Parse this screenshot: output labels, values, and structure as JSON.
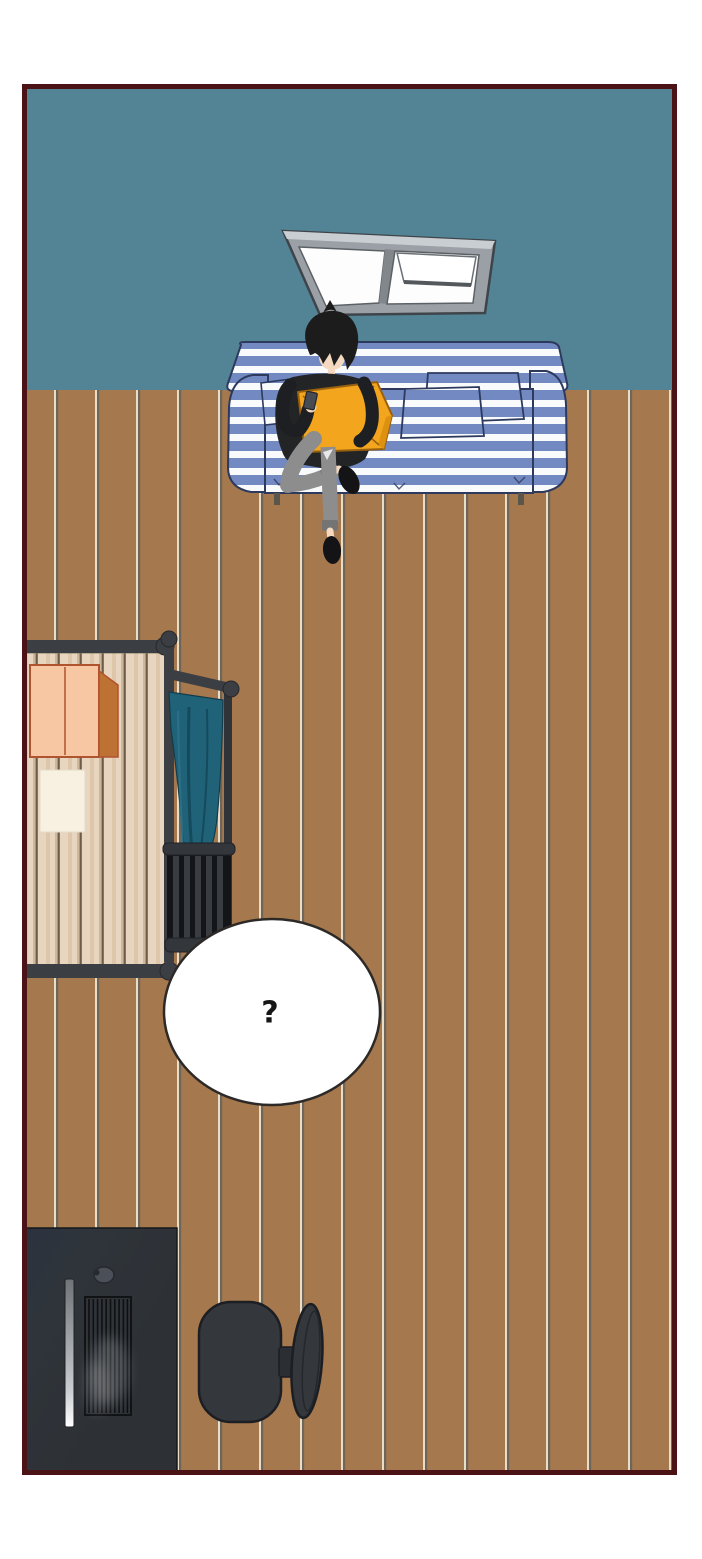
{
  "scene": {
    "type": "webtoon-room-panel",
    "description": "top-down illustrated room with person on striped sofa",
    "speech_bubble": {
      "text": "?"
    },
    "objects": [
      "teal-wall",
      "wood-plank-floor",
      "tilted-window",
      "striped-sofa",
      "person-with-phone",
      "orange-cushion",
      "slatted-wood-table",
      "cardboard-box",
      "paper-sheet",
      "clothes-rack",
      "teal-hanging-cloth",
      "slatted-dark-chair",
      "speech-bubble",
      "computer-desk",
      "mouse",
      "ribbed-keyboard-panel",
      "office-chair"
    ]
  },
  "palette": {
    "page_background": "#ffffff",
    "panel_border": "#4c1317",
    "wall_teal": "#538496",
    "floor_brown": "#a6784e",
    "floor_seam_light": "#e9ddc6",
    "floor_seam_dark": "#6e655b",
    "sofa_blue": "#7289c2",
    "sofa_stripe_white": "#f8fafc",
    "sofa_outline_navy": "#2d3a5e",
    "cushion_orange": "#f2a51d",
    "skin": "#f4d8c0",
    "hair_black": "#1c1c1c",
    "sweater_black": "#222426",
    "jeans_gray": "#8d8d8d",
    "slipper_black": "#141417",
    "table_wood_light": "#e8d5bf",
    "table_frame_dark": "#3b3e43",
    "box_peach": "#f6c7a2",
    "box_side_brown": "#bd7233",
    "paper_cream": "#f8f1e2",
    "cloth_teal": "#206379",
    "chair_slat_dark": "#33363b",
    "bubble_fill": "#ffffff",
    "bubble_outline": "#2c2927",
    "question_mark_color": "#161616",
    "desk_dark": "#2f343a",
    "window_frame_gray": "#9aa0a5",
    "window_pane_white": "#fdfdfd"
  }
}
